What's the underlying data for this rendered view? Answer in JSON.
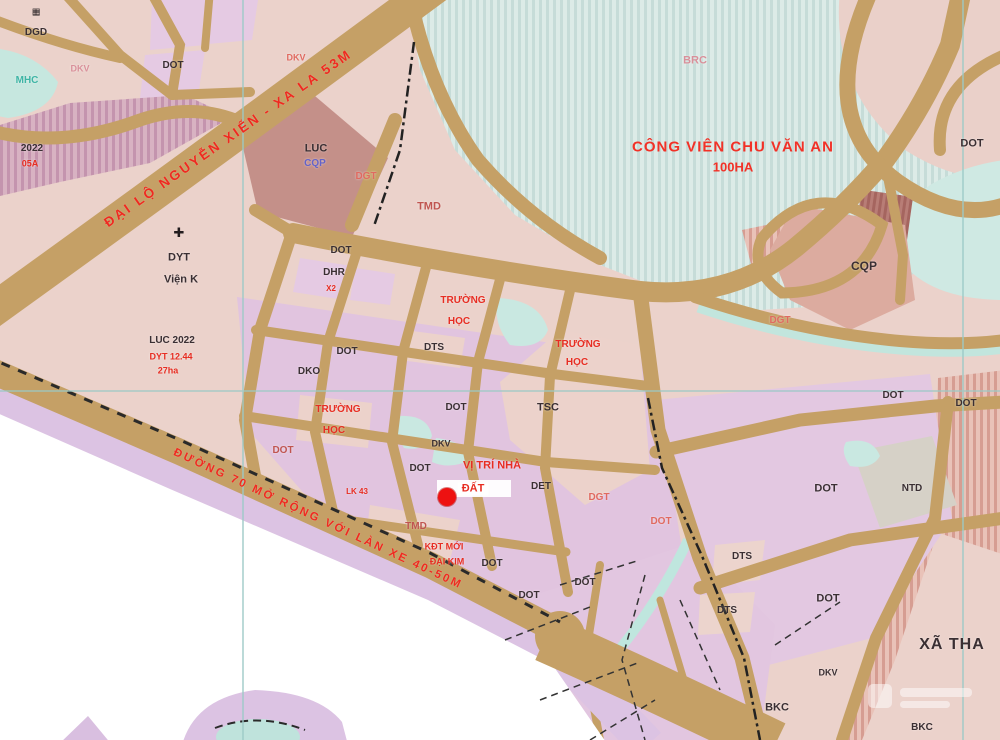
{
  "colors": {
    "road_tan": "#c5a066",
    "park_fill": "#dcebe7",
    "label_red": "#e72d22",
    "marker_red": "#ee1111",
    "parcel_lavender": "#e1c4df",
    "outside_white": "#ffffff",
    "gridline_teal": "#9ccac6"
  },
  "roads": {
    "main_label": "ĐẠI LỘ NGUYỄN XIỂN - XA LA 53M",
    "road70_label": "ĐƯỜNG 70 MỞ RỘNG VỚI LÀN XE 40-50M"
  },
  "park": {
    "title": "CÔNG VIÊN CHU VĂN AN",
    "area_label": "100HA"
  },
  "poi": {
    "hospital_icon": "✚",
    "school_icon": "▦"
  },
  "labels": [
    "DGD",
    "MHC",
    "DKV",
    "DOT",
    "2022",
    "05A",
    "DKV",
    "LUC",
    "CQP",
    "DGT",
    "TMD",
    "DYT",
    "Viện K",
    "LUC 2022",
    "DYT 12.44",
    "27ha",
    "DOT",
    "DHR",
    "X2",
    "TRƯỜNG",
    "HỌC",
    "DTS",
    "DOT",
    "DKO",
    "TRƯỜNG",
    "HỌC",
    "TRƯỜNG",
    "HỌC",
    "TSC",
    "DOT",
    "DKV",
    "DOT",
    "VỊ TRÍ NHÀ",
    "ĐẤT",
    "DET",
    "DGT",
    "DOT",
    "LK 43",
    "DOT",
    "TMD",
    "KĐT MỚI",
    "ĐẠI KIM",
    "DOT",
    "DOT",
    "DOT",
    "DTS",
    "DTS",
    "DOT",
    "XÃ THA",
    "BKC",
    "BKC",
    "DKV",
    "DOT",
    "DOT",
    "DOT",
    "CQP",
    "DGT",
    "DOT",
    "NTD",
    "BRC"
  ]
}
